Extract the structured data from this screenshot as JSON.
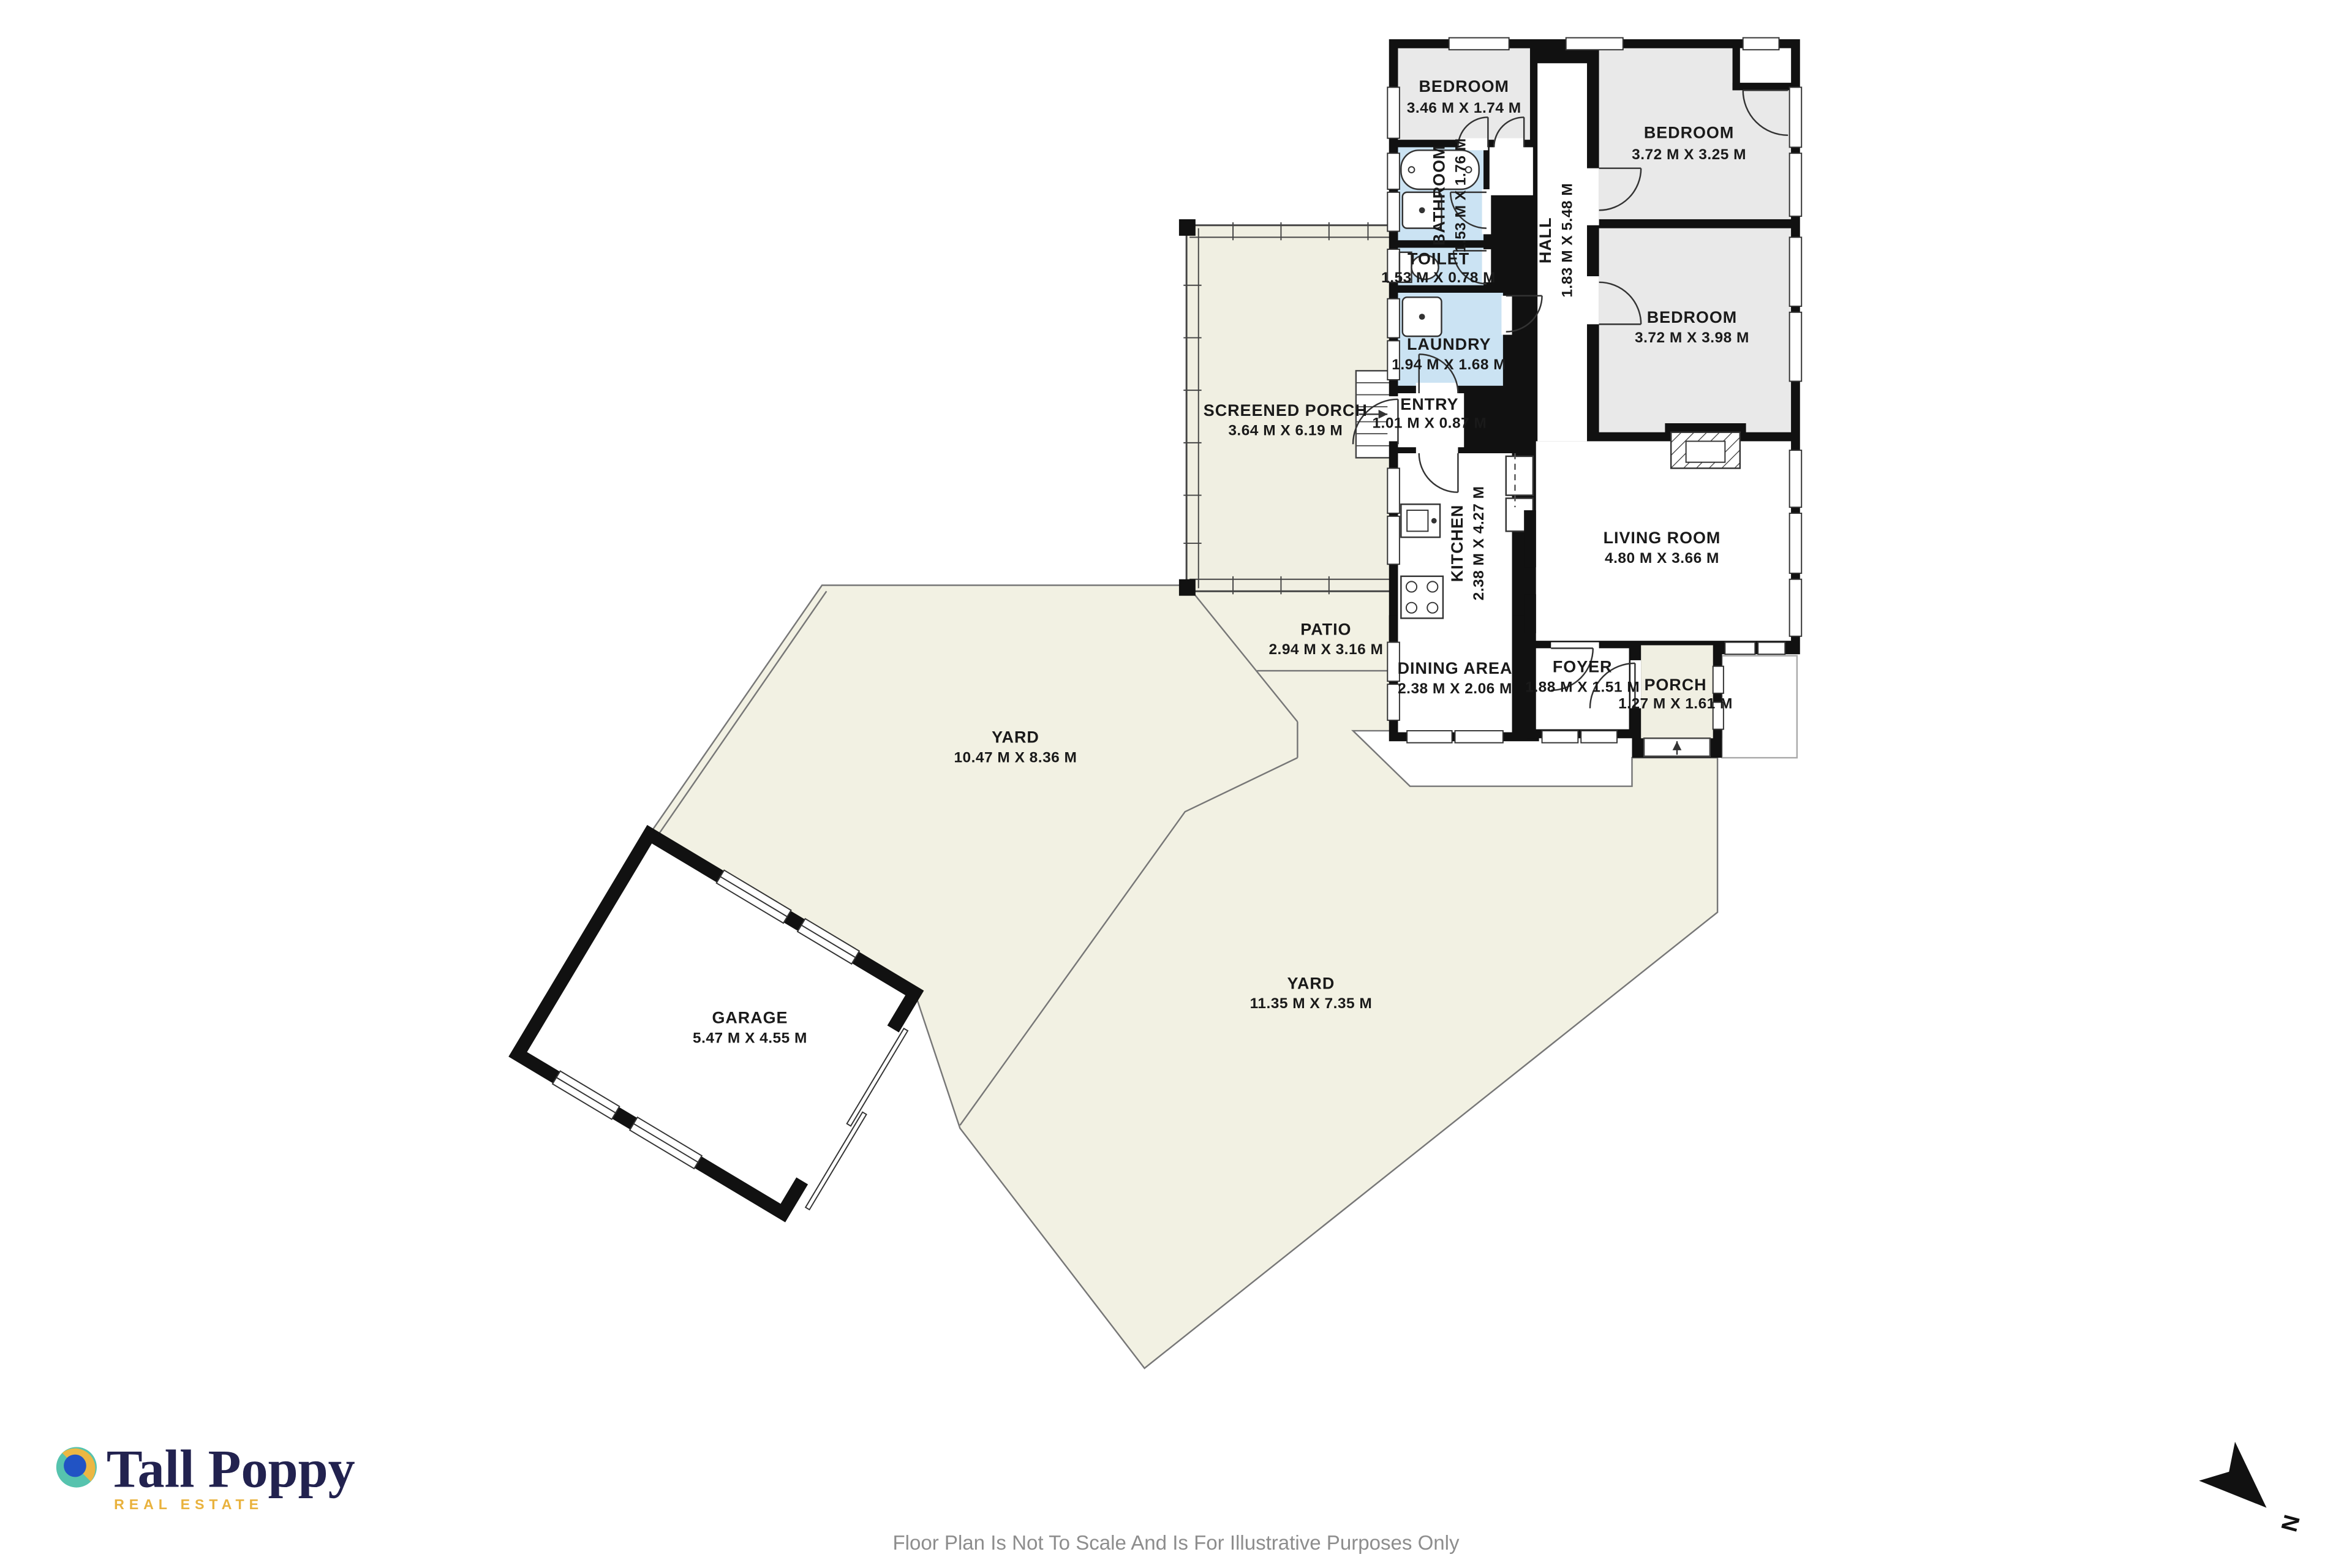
{
  "rooms": [
    {
      "name": "BEDROOM",
      "dims": "3.46 M X 1.74 M"
    },
    {
      "name": "BEDROOM",
      "dims": "3.72 M X 3.25 M"
    },
    {
      "name": "BATHROOM",
      "dims": "1.53 M X 1.76 M"
    },
    {
      "name": "TOILET",
      "dims": "1.53 M X 0.78 M"
    },
    {
      "name": "LAUNDRY",
      "dims": "1.94 M X 1.68 M"
    },
    {
      "name": "HALL",
      "dims": "1.83 M X 5.48 M"
    },
    {
      "name": "BEDROOM",
      "dims": "3.72 M X 3.98 M"
    },
    {
      "name": "SCREENED PORCH",
      "dims": "3.64 M X 6.19 M"
    },
    {
      "name": "ENTRY",
      "dims": "1.01 M X 0.87 M"
    },
    {
      "name": "KITCHEN",
      "dims": "2.38 M X 4.27 M"
    },
    {
      "name": "LIVING ROOM",
      "dims": "4.80 M X 3.66 M"
    },
    {
      "name": "PATIO",
      "dims": "2.94 M X 3.16 M"
    },
    {
      "name": "DINING AREA",
      "dims": "2.38 M X 2.06 M"
    },
    {
      "name": "FOYER",
      "dims": "1.88 M X 1.51 M"
    },
    {
      "name": "PORCH",
      "dims": "1.27 M X 1.61 M"
    },
    {
      "name": "YARD",
      "dims": "10.47 M X 8.36 M"
    },
    {
      "name": "YARD",
      "dims": "11.35 M X 7.35 M"
    },
    {
      "name": "GARAGE",
      "dims": "5.47 M X 4.55 M"
    }
  ],
  "branding": {
    "logo_text": "Tall Poppy",
    "logo_subtext": "REAL ESTATE"
  },
  "footer": {
    "disclaimer": "Floor Plan Is Not To Scale And Is For Illustrative Purposes Only"
  },
  "compass": {
    "label": "N"
  },
  "colors": {
    "wall": "#111111",
    "room_gray": "#e9e9e9",
    "wet_blue": "#cbe3f3",
    "outdoor_cream": "#f2f1e3",
    "brand_navy": "#22224f",
    "brand_gold": "#e9b23d",
    "brand_teal": "#56c3ae",
    "brand_blue": "#2153c4",
    "footer_gray": "#8d8d8d"
  }
}
